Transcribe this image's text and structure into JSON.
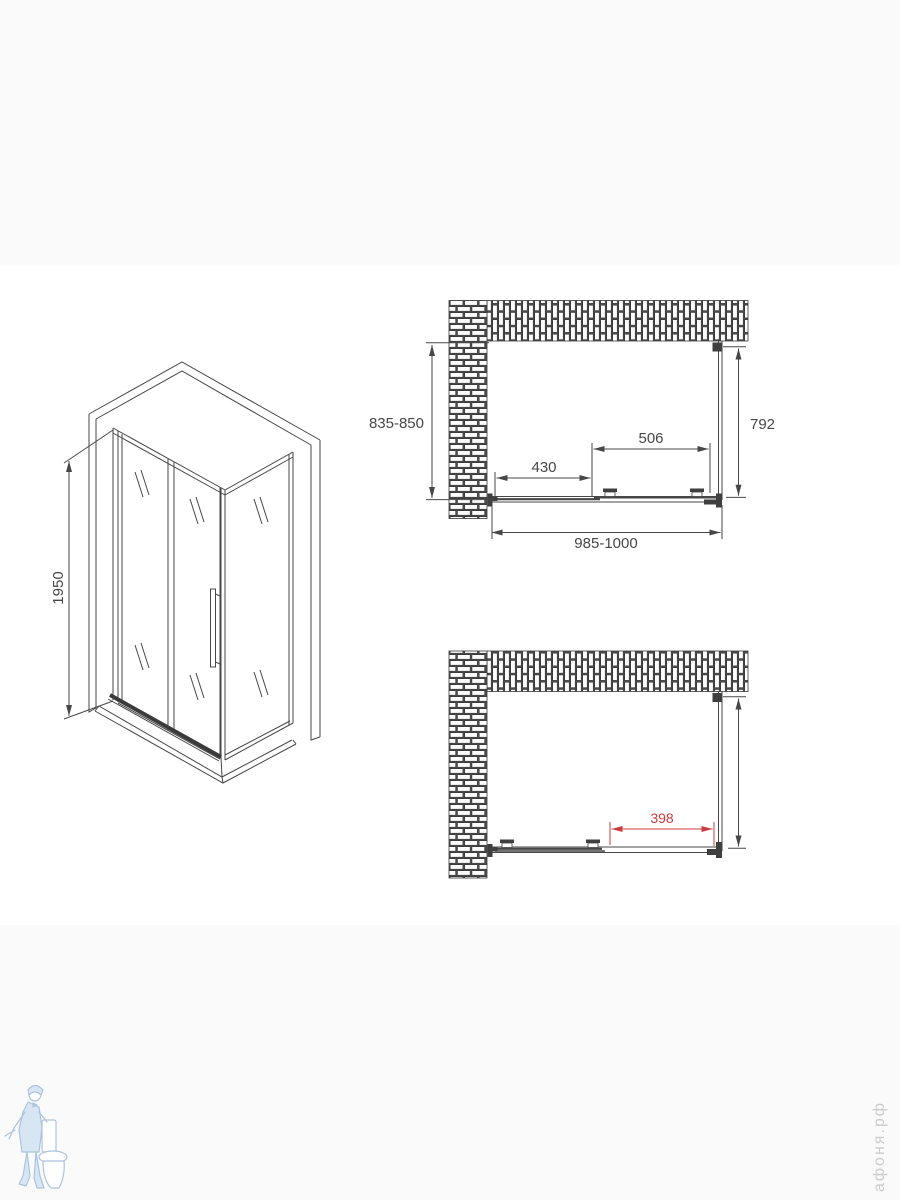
{
  "page": {
    "background": "#ffffff",
    "band_color": "#fafafa"
  },
  "colors": {
    "line": "#474747",
    "dimension_red": "#cc3b3b",
    "watermark_blue": "#aac4df",
    "watermark_gray": "#cccccc"
  },
  "iso_view": {
    "height_label": "1950"
  },
  "top_plan": {
    "depth_range_label": "835-850",
    "glass_height_label": "792",
    "door_width_label": "506",
    "fixed_panel_label": "430",
    "width_range_label": "985-1000"
  },
  "bottom_plan": {
    "opening_label": "398"
  },
  "watermark": {
    "brand": "афоня.рф",
    "logo": "plumber-with-toilet-icon"
  }
}
